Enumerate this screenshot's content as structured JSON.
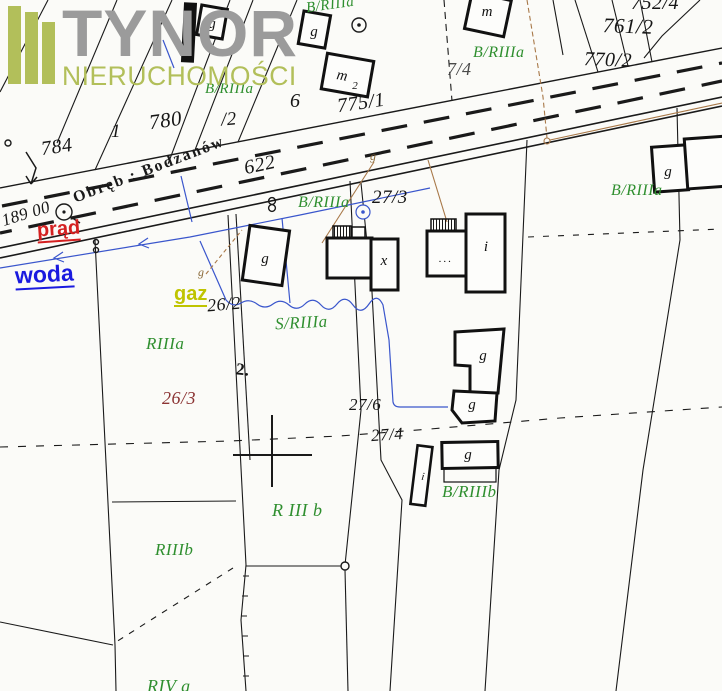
{
  "logo": {
    "title": "TYNOR",
    "subtitle": "NIERUCHOMOŚCI"
  },
  "road": {
    "name": "Obręb : Bodzanów",
    "number": "622",
    "measurement": "189 00"
  },
  "parcels": {
    "p752_4": "752/4",
    "p761_2": "761/2",
    "p770_2": "770/2",
    "p775_1": "775/1",
    "p7_4": "7/4",
    "p780": "780",
    "p784": "784",
    "p1": "1",
    "p6": "6",
    "p_2": "/2",
    "p26_2": "26/2",
    "p26_3": "26/3",
    "p27_3": "27/3",
    "p27_4": "27/4",
    "p27_6": "27/6",
    "pt2": "2."
  },
  "soil_labels": {
    "b_riiia": "B/RIIIa",
    "s_riiia": "S/RIIIa",
    "riiia": "RIIIa",
    "riiib": "RIIIb",
    "b_riiib": "B/RIIIb",
    "r_iii_b": "R III b",
    "riv_a": "RIV a"
  },
  "utilities": {
    "prad": "prąd",
    "woda": "woda",
    "gaz": "gaz",
    "gas_marker": "g"
  },
  "buildings": {
    "g": "g",
    "m": "m",
    "m2_base": "m",
    "m2_sub": "2",
    "x": "x",
    "i": "i",
    "dots": "..."
  },
  "colors": {
    "soil_green": "#2f8f2f",
    "prad_red": "#d42020",
    "woda_blue": "#1a1adf",
    "gaz_yellow": "#bfc400",
    "parcel_dark_red": "#8b3333",
    "water_line": "#3a56cc",
    "gas_line": "#a87848",
    "logo_olive": "#b2bf5a",
    "logo_gray": "#9b9b9b"
  }
}
